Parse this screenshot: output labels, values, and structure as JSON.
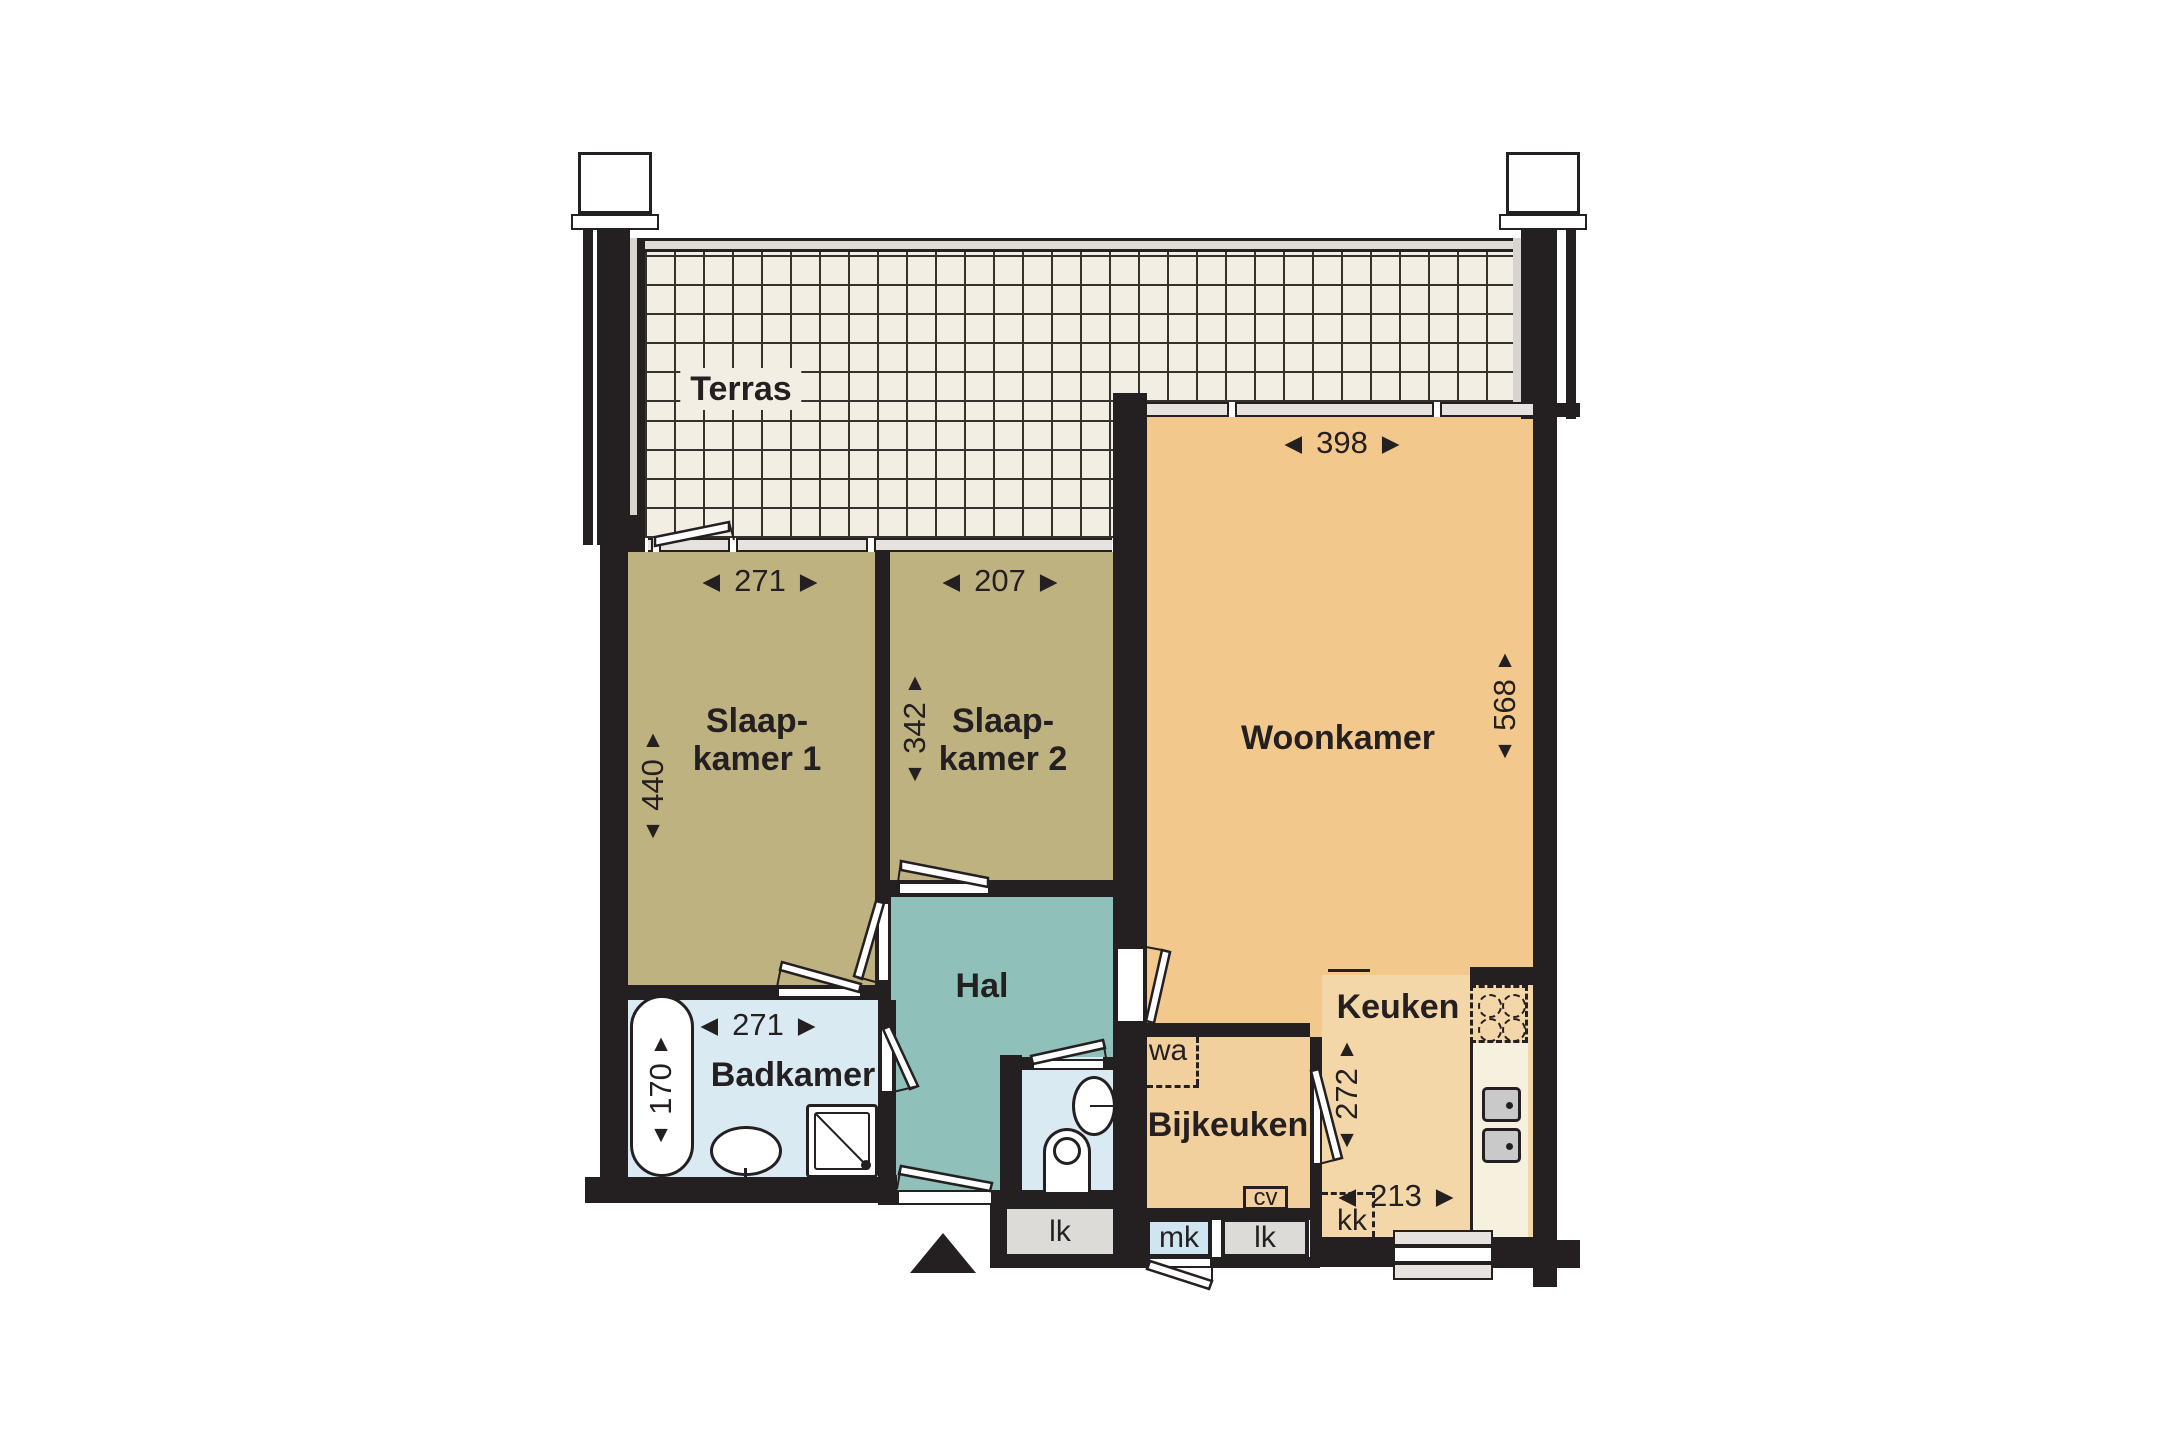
{
  "rooms": {
    "terras": {
      "label": "Terras"
    },
    "slaapkamer1": {
      "label_line1": "Slaap-",
      "label_line2": "kamer 1",
      "width_cm": "271",
      "depth_cm": "440"
    },
    "slaapkamer2": {
      "label_line1": "Slaap-",
      "label_line2": "kamer 2",
      "width_cm": "207",
      "depth_cm": "342"
    },
    "woonkamer": {
      "label": "Woonkamer",
      "width_cm": "398",
      "depth_cm": "568"
    },
    "hal": {
      "label": "Hal"
    },
    "badkamer": {
      "label": "Badkamer",
      "width_cm": "271",
      "bath_length_cm": "170"
    },
    "bijkeuken": {
      "label": "Bijkeuken"
    },
    "keuken": {
      "label": "Keuken",
      "width_cm": "213",
      "depth_cm": "272"
    }
  },
  "fixture_labels": {
    "washer": "wa",
    "boiler": "cv",
    "fridge": "kk",
    "meter_cupboard": "mk",
    "shaft_left": "lk",
    "shaft_right": "lk"
  },
  "icons": {
    "arrow_left": "◀",
    "arrow_right": "▶",
    "arrow_up": "▲",
    "arrow_down": "▼",
    "entrance_marker": "▲"
  },
  "colors": {
    "wall": "#241F20",
    "terrace_tile": "#F3EEE3",
    "tile_line": "#35322E",
    "bedroom": "#BEB281",
    "hall": "#8FC0BA",
    "bathroom": "#DAEAF2",
    "living": "#F3C88C",
    "kitchen": "#F3D7A8",
    "utility": "#F2D09E",
    "counter": "#F6F0DE",
    "appliance": "#C9C9C9",
    "shaft": "#DCDBD8",
    "meter": "#CFE5EF",
    "window": "#E6E3DE"
  }
}
